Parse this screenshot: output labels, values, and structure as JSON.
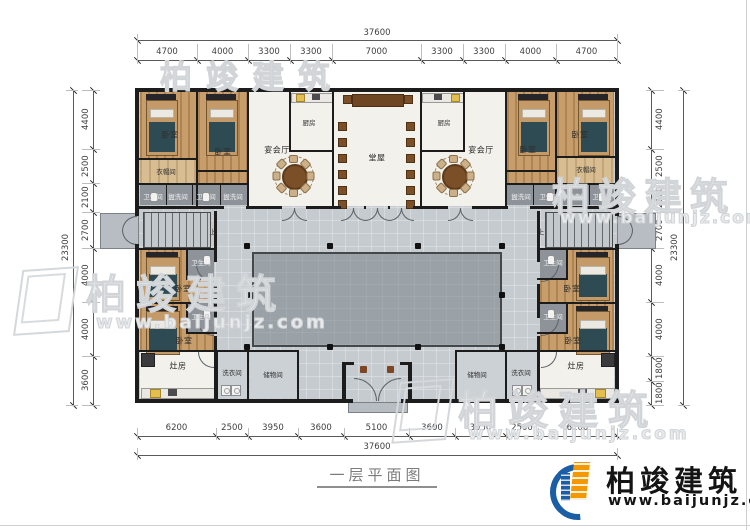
{
  "title": "一层平面图",
  "labels": {
    "bedroom": "卧室",
    "banquet_hall": "宴会厅",
    "main_hall": "堂屋",
    "kitchen": "厨房",
    "cloakroom": "衣帽间",
    "toilet": "卫生间",
    "washroom": "盥洗间",
    "stove_room": "灶房",
    "laundry_room": "洗衣间",
    "storage_room": "储物间",
    "stairs_up": "上"
  },
  "dimensions": {
    "top": {
      "total": "37600",
      "segments": [
        "4700",
        "4000",
        "3300",
        "3300",
        "7000",
        "3300",
        "3300",
        "4000",
        "4700"
      ]
    },
    "bottom": {
      "total": "37600",
      "segments": [
        "6200",
        "2500",
        "3950",
        "3600",
        "5100",
        "3600",
        "3950",
        "2500",
        "6200"
      ]
    },
    "left": {
      "total": "23300",
      "segments": [
        "4400",
        "2500",
        "2100",
        "2700",
        "4000",
        "4000",
        "3600"
      ]
    },
    "right": {
      "total": "23300",
      "segments": [
        "4400",
        "2500",
        "2100",
        "2700",
        "4000",
        "4000",
        "1800",
        "1800"
      ]
    }
  },
  "branding": {
    "company": "柏竣建筑",
    "website": "www.baijunjz.com"
  },
  "watermark": {
    "company": "柏竣建筑",
    "website": "www.baijunjz.com"
  },
  "colors": {
    "wall": "#1c1c1c",
    "floor": "#c6cbd0",
    "courtyard": "#9aa1a7",
    "wood": "#c79e6b",
    "logo_orange": "#f39800",
    "logo_blue": "#1b5ea6",
    "watermark": "#d5d8da"
  }
}
